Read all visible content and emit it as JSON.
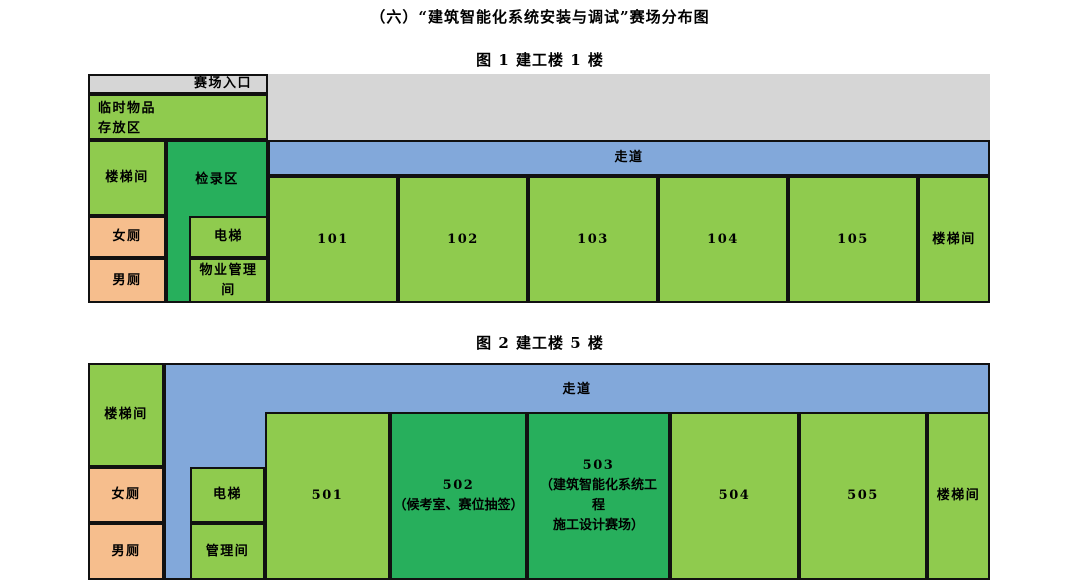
{
  "document": {
    "title": "（六）“建筑智能化系统安装与调试”赛场分布图",
    "figure1_caption": "图 1 建工楼 1 楼",
    "figure2_caption": "图 2 建工楼 5 楼"
  },
  "palette": {
    "room_green": "#8fcb4e",
    "highlight_green": "#27af5c",
    "corridor_blue": "#82a8da",
    "toilet_orange": "#f6be8d",
    "entrance_gray": "#d6d6d6",
    "line_black": "#111111"
  },
  "figure1": {
    "entrance": "赛场入口",
    "storage": {
      "line1": "临时物品",
      "line2": "存放区"
    },
    "stair_left": "楼梯间",
    "checkin": "检录区",
    "women": "女厕",
    "men": "男厕",
    "elevator": "电梯",
    "property": {
      "line1": "物业管理",
      "line2": "间"
    },
    "corridor": "走道",
    "rooms": [
      "101",
      "102",
      "103",
      "104",
      "105"
    ],
    "stair_right": "楼梯间"
  },
  "figure2": {
    "stair_left": "楼梯间",
    "women": "女厕",
    "men": "男厕",
    "elevator": "电梯",
    "management": "管理间",
    "corridor": "走道",
    "room501": "501",
    "room502": {
      "num": "502",
      "note": "（候考室、赛位抽签）"
    },
    "room503": {
      "num": "503",
      "note_line1": "（建筑智能化系统工",
      "note_line2": "程",
      "note_line3": "施工设计赛场）"
    },
    "room504": "504",
    "room505": "505",
    "stair_right": "楼梯间"
  }
}
